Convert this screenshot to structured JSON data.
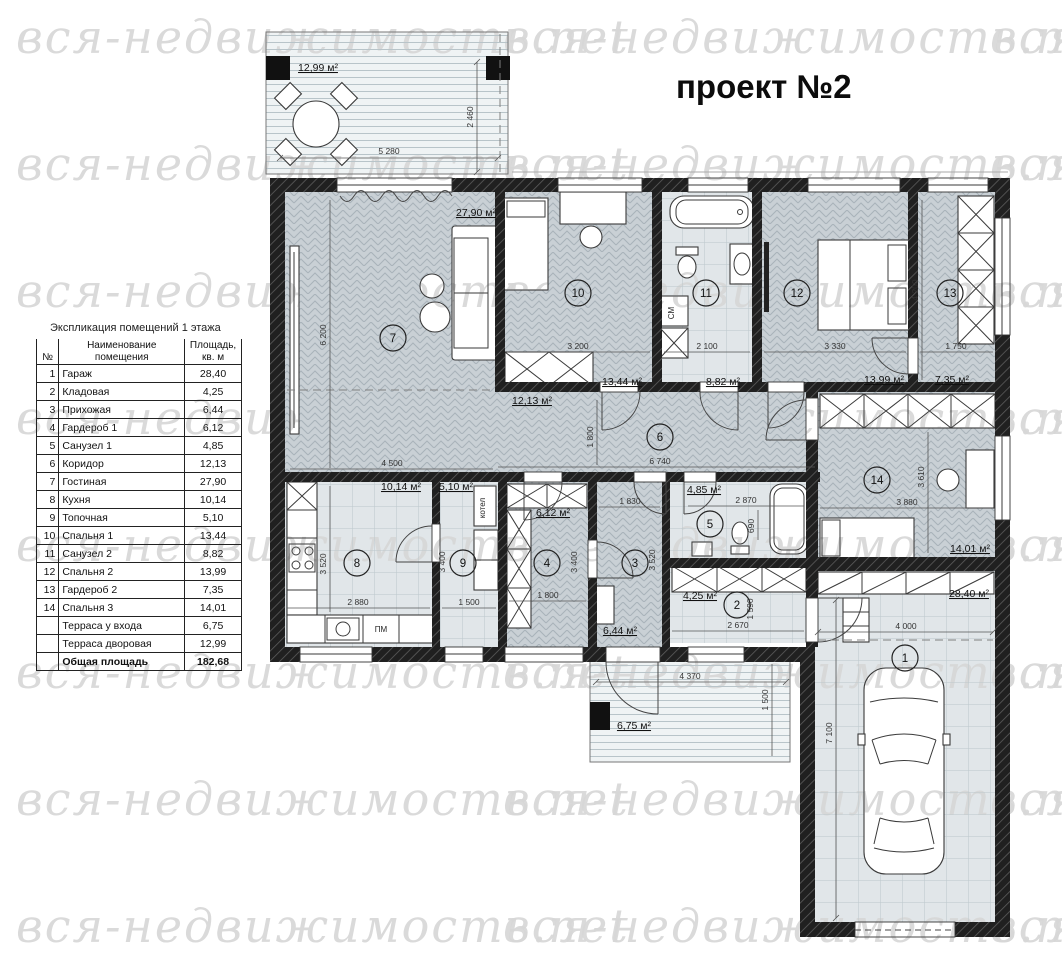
{
  "title": "проект №2",
  "watermark": "вся-недвижимость.net",
  "legend": {
    "title": "Экспликация помещений 1 этажа",
    "columns": {
      "no": "№",
      "name": "Наименование\nпомещения",
      "area": "Площадь,\nкв. м"
    },
    "rows": [
      {
        "no": "1",
        "name": "Гараж",
        "area": "28,40"
      },
      {
        "no": "2",
        "name": "Кладовая",
        "area": "4,25"
      },
      {
        "no": "3",
        "name": "Прихожая",
        "area": "6,44"
      },
      {
        "no": "4",
        "name": "Гардероб 1",
        "area": "6,12"
      },
      {
        "no": "5",
        "name": "Санузел 1",
        "area": "4,85"
      },
      {
        "no": "6",
        "name": "Коридор",
        "area": "12,13"
      },
      {
        "no": "7",
        "name": "Гостиная",
        "area": "27,90"
      },
      {
        "no": "8",
        "name": "Кухня",
        "area": "10,14"
      },
      {
        "no": "9",
        "name": "Топочная",
        "area": "5,10"
      },
      {
        "no": "10",
        "name": "Спальня 1",
        "area": "13,44"
      },
      {
        "no": "11",
        "name": "Санузел 2",
        "area": "8,82"
      },
      {
        "no": "12",
        "name": "Спальня 2",
        "area": "13,99"
      },
      {
        "no": "13",
        "name": "Гардероб 2",
        "area": "7,35"
      },
      {
        "no": "14",
        "name": "Спальня 3",
        "area": "14,01"
      },
      {
        "no": "",
        "name": "Терраса у входа",
        "area": "6,75"
      },
      {
        "no": "",
        "name": "Терраса дворовая",
        "area": "12,99"
      },
      {
        "no": "",
        "name": "Общая площадь",
        "area": "182,68",
        "bold": true
      }
    ]
  },
  "plan": {
    "rooms": {
      "r1": {
        "num": "1",
        "area": "28,40 м²",
        "w": "4 000",
        "h": "7 100"
      },
      "r2": {
        "num": "2",
        "area": "4,25 м²",
        "w": "2 670",
        "h": "1 590"
      },
      "r3": {
        "num": "3",
        "area": "6,44 м²",
        "w": "1 830",
        "h": "3 520"
      },
      "r4": {
        "num": "4",
        "area": "6,12 м²",
        "w": "1 800",
        "h": "3 400"
      },
      "r5": {
        "num": "5",
        "area": "4,85 м²",
        "w": "2 870",
        "h": "690"
      },
      "r6": {
        "num": "6",
        "area": "12,13 м²",
        "w": "6 740",
        "h": "1 800"
      },
      "r7": {
        "num": "7",
        "area": "27,90 м²",
        "w": "4 500",
        "h": "6 200"
      },
      "r8": {
        "num": "8",
        "area": "10,14 м²",
        "w": "2 880",
        "h": "3 520"
      },
      "r9": {
        "num": "9",
        "area": "5,10 м²",
        "w": "1 500",
        "h": "3 400"
      },
      "r10": {
        "num": "10",
        "area": "13,44 м²",
        "w": "3 200"
      },
      "r11": {
        "num": "11",
        "area": "8,82 м²",
        "w": "2 100"
      },
      "r12": {
        "num": "12",
        "area": "13,99 м²",
        "w": "3 330"
      },
      "r13": {
        "num": "13",
        "area": "7,35 м²",
        "w": "1 750",
        "h": "4 200"
      },
      "r14": {
        "num": "14",
        "area": "14,01 м²",
        "w": "3 880",
        "h": "3 610"
      }
    },
    "terraces": {
      "top": {
        "area": "12,99 м²",
        "w": "5 280",
        "h": "2 460"
      },
      "entrance": {
        "area": "6,75 м²",
        "w": "4 370",
        "h": "1 500"
      }
    },
    "labels": {
      "boiler": "котел",
      "dishwasher": "ПМ",
      "washer": "СМ"
    }
  }
}
